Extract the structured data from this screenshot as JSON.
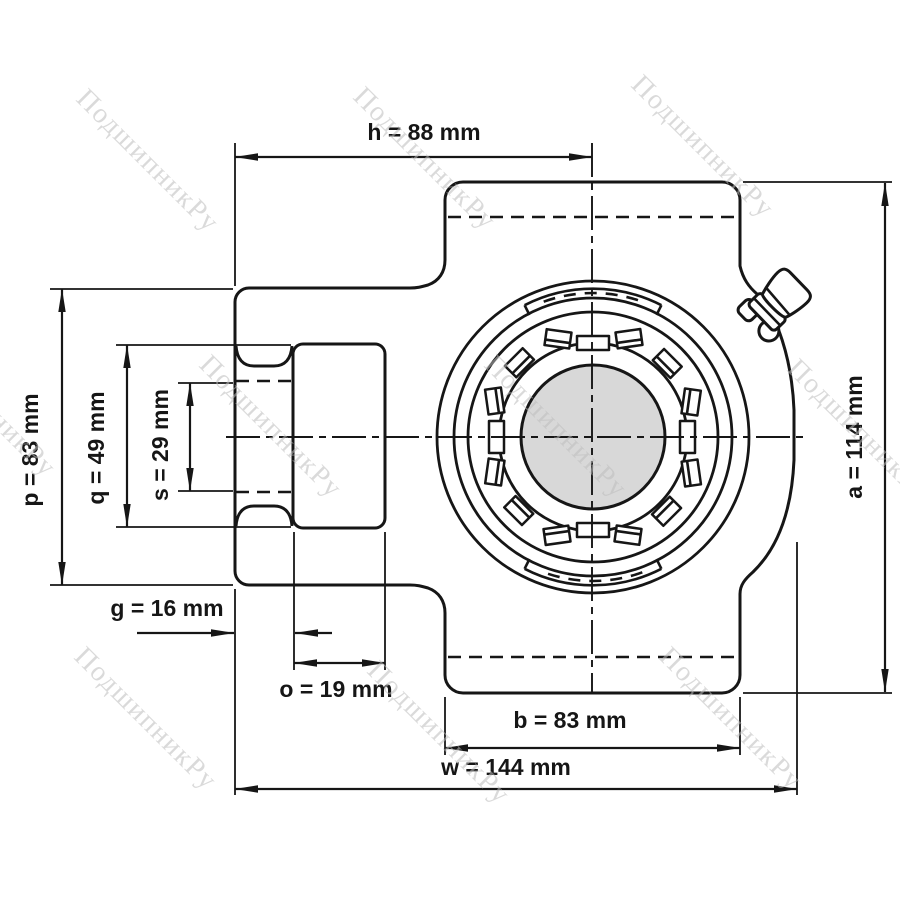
{
  "drawing": {
    "type": "take-up bearing housing unit, front view technical drawing",
    "units": "mm",
    "dimensions": {
      "h": {
        "name": "h",
        "value": 88,
        "unit": "mm",
        "label": "h = 88 mm"
      },
      "p": {
        "name": "p",
        "value": 83,
        "unit": "mm",
        "label": "p = 83 mm"
      },
      "q": {
        "name": "q",
        "value": 49,
        "unit": "mm",
        "label": "q = 49 mm"
      },
      "s": {
        "name": "s",
        "value": 29,
        "unit": "mm",
        "label": "s = 29 mm"
      },
      "g": {
        "name": "g",
        "value": 16,
        "unit": "mm",
        "label": "g = 16 mm"
      },
      "o": {
        "name": "o",
        "value": 19,
        "unit": "mm",
        "label": "o = 19 mm"
      },
      "b": {
        "name": "b",
        "value": 83,
        "unit": "mm",
        "label": "b = 83 mm"
      },
      "w": {
        "name": "w",
        "value": 144,
        "unit": "mm",
        "label": "w = 144 mm"
      },
      "a": {
        "name": "a",
        "value": 114,
        "unit": "mm",
        "label": "a = 114 mm"
      }
    },
    "watermark": {
      "text": "ПодшипникРу",
      "color": "#c6c6c6"
    },
    "colors": {
      "background": "#ffffff",
      "line": "#161616",
      "bore_fill": "#d8d8d8"
    }
  }
}
